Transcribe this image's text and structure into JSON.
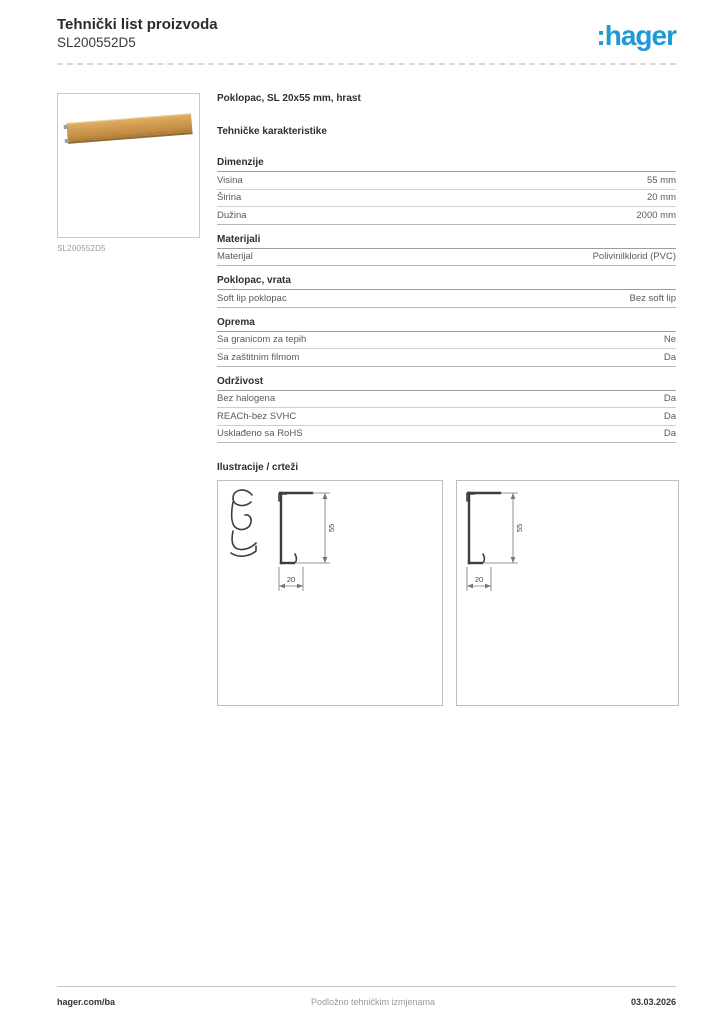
{
  "header": {
    "title": "Tehnički list proizvoda",
    "product_id": "SL200552D5",
    "logo_prefix": ":",
    "logo_text": "hager",
    "brand_color": "#2199d4"
  },
  "product": {
    "image_caption": "SL200552D5",
    "name": "Poklopac, SL 20x55 mm, hrast",
    "oak_color": "#d09b50"
  },
  "characteristics": {
    "heading": "Tehničke karakteristike",
    "sections": [
      {
        "title": "Dimenzije",
        "rows": [
          {
            "label": "Visina",
            "value": "55 mm"
          },
          {
            "label": "Širina",
            "value": "20 mm"
          },
          {
            "label": "Dužina",
            "value": "2000 mm"
          }
        ]
      },
      {
        "title": "Materijali",
        "rows": [
          {
            "label": "Materijal",
            "value": "Polivinilklorid (PVC)"
          }
        ]
      },
      {
        "title": "Poklopac, vrata",
        "rows": [
          {
            "label": "Soft lip poklopac",
            "value": "Bez soft lip"
          }
        ]
      },
      {
        "title": "Oprema",
        "rows": [
          {
            "label": "Sa granicom za tepih",
            "value": "Ne"
          },
          {
            "label": "Sa zaštitnim filmom",
            "value": "Da"
          }
        ]
      },
      {
        "title": "Održivost",
        "rows": [
          {
            "label": "Bez halogena",
            "value": "Da"
          },
          {
            "label": "REACh-bez SVHC",
            "value": "Da"
          },
          {
            "label": "Usklađeno sa RoHS",
            "value": "Da"
          }
        ]
      }
    ]
  },
  "illustrations": {
    "heading": "Ilustracije / crteži",
    "drawing1": {
      "dim_height": "55",
      "dim_width": "20"
    },
    "drawing2": {
      "dim_height": "55",
      "dim_width": "20"
    }
  },
  "footer": {
    "left": "hager.com/ba",
    "center": "Podložno tehničkim izmjenama",
    "right": "03.03.2026"
  }
}
